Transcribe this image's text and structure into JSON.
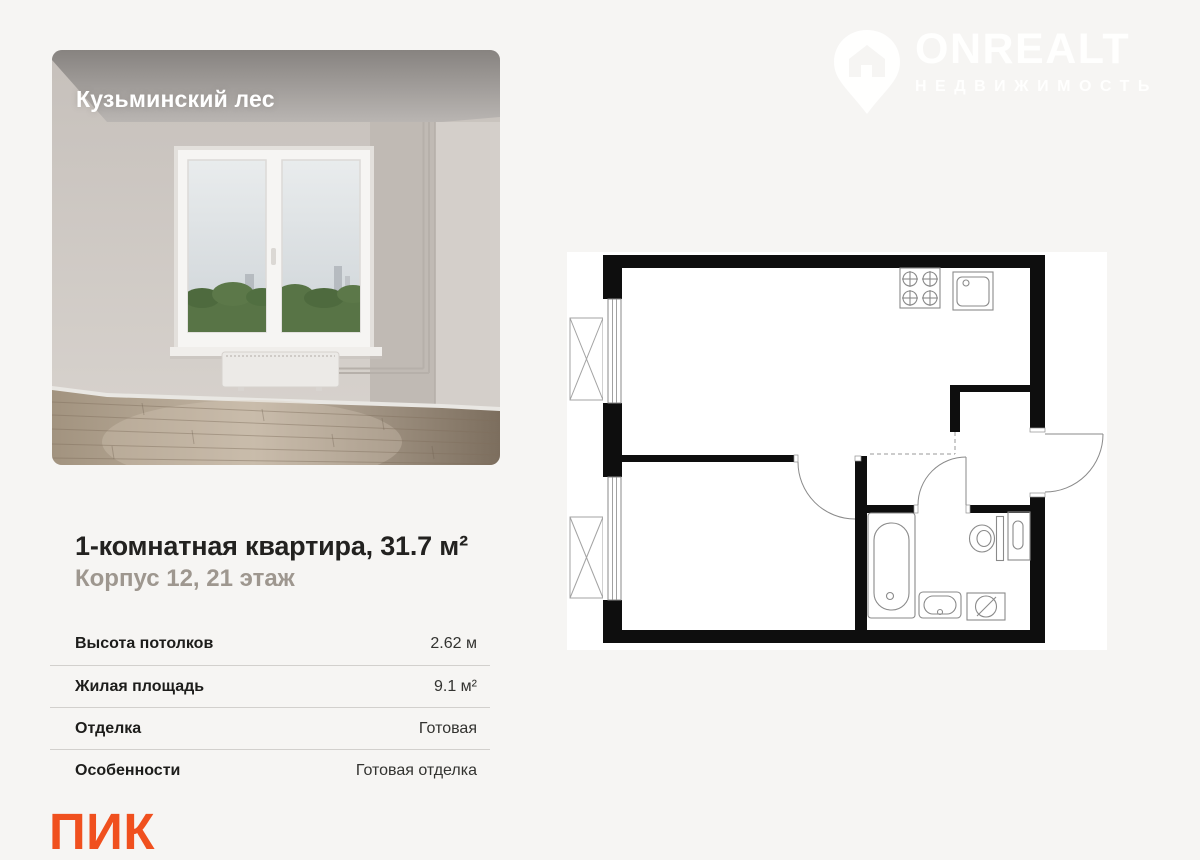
{
  "page": {
    "background_color": "#f6f5f3"
  },
  "photo_card": {
    "project_label": "Кузьминский лес"
  },
  "watermark": {
    "brand": "ONREALT",
    "tagline": "НЕДВИЖИМОСТЬ",
    "icon": "house-location-pin-icon"
  },
  "listing": {
    "title": "1-комнатная квартира, 31.7 м²",
    "subtitle": "Корпус 12, 21 этаж",
    "specs": [
      {
        "label": "Высота потолков",
        "value": "2.62 м"
      },
      {
        "label": "Жилая площадь",
        "value": "9.1 м²"
      },
      {
        "label": "Отделка",
        "value": "Готовая"
      },
      {
        "label": "Особенности",
        "value": "Готовая отделка"
      }
    ]
  },
  "developer": {
    "name": "ПИК",
    "logo_color": "#F0501E"
  },
  "floorplan": {
    "wall_color": "#0e0e0e",
    "fixtures": [
      "stove",
      "kitchen-sink",
      "bathtub",
      "washbasin",
      "washing-machine",
      "toilet",
      "bathroom-shelf",
      "window",
      "window",
      "balcony",
      "balcony",
      "entrance-door",
      "room-door",
      "bathroom-door"
    ]
  }
}
